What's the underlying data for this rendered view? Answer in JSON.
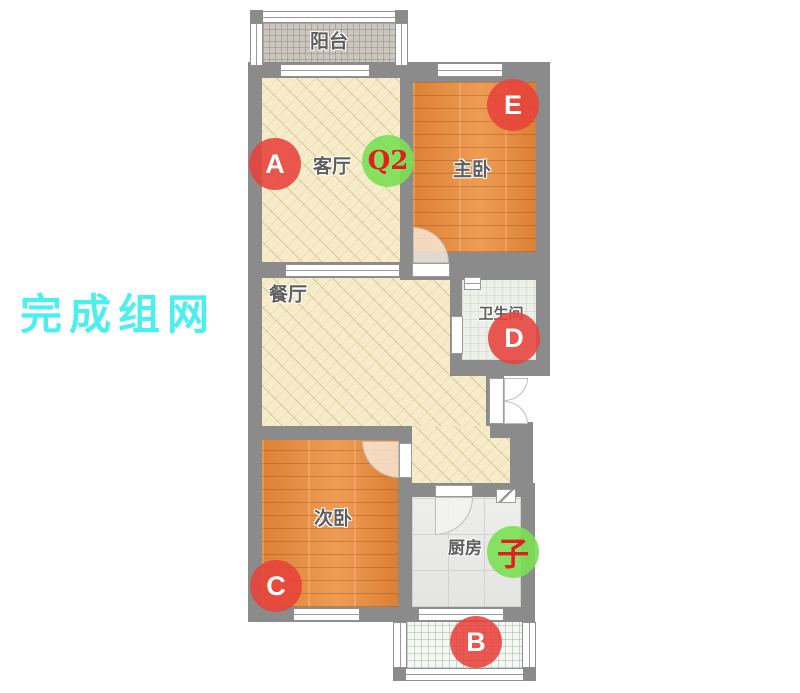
{
  "watermark": {
    "text": "完成组网",
    "color": "#4BEFEF"
  },
  "rooms": [
    {
      "id": "balcony-top",
      "label": "阳台"
    },
    {
      "id": "living-room",
      "label": "客厅"
    },
    {
      "id": "master-bedroom",
      "label": "主卧"
    },
    {
      "id": "dining-room",
      "label": "餐厅"
    },
    {
      "id": "bathroom",
      "label": "卫生间"
    },
    {
      "id": "second-bedroom",
      "label": "次卧"
    },
    {
      "id": "kitchen",
      "label": "厨房"
    }
  ],
  "markers": [
    {
      "id": "A",
      "label": "A",
      "color": "red",
      "room": "living-room"
    },
    {
      "id": "Q2",
      "label": "Q2",
      "color": "green",
      "room": "living-room"
    },
    {
      "id": "E",
      "label": "E",
      "color": "red",
      "room": "master-bedroom"
    },
    {
      "id": "D",
      "label": "D",
      "color": "red",
      "room": "bathroom"
    },
    {
      "id": "C",
      "label": "C",
      "color": "red",
      "room": "second-bedroom"
    },
    {
      "id": "zi",
      "label": "子",
      "color": "green",
      "room": "kitchen"
    },
    {
      "id": "B",
      "label": "B",
      "color": "red",
      "room": "balcony-bottom"
    }
  ],
  "icons": {
    "bathroom_window": "window-icon",
    "kitchen_hood": "range-hood-icon"
  },
  "colors": {
    "wall": "#8B8B8B",
    "marker_red": "#E7423A",
    "marker_green": "#7BE054",
    "marker_text_red": "#E01F1F",
    "wood_floor": "#E28B41",
    "cream_floor": "#F6ECCA",
    "watermark": "#4BEFEF"
  }
}
